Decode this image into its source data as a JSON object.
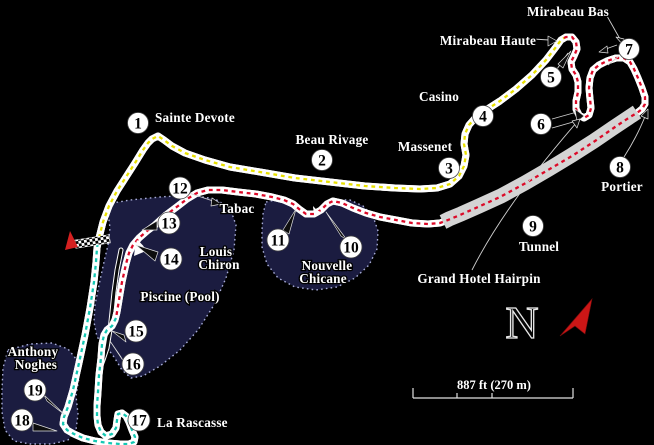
{
  "map": {
    "type": "circuit-map",
    "corners": [
      {
        "num": "1",
        "name": "Sainte Devote"
      },
      {
        "num": "2",
        "name": "Beau Rivage"
      },
      {
        "num": "3",
        "name": "Massenet"
      },
      {
        "num": "4",
        "name": "Casino"
      },
      {
        "num": "5",
        "name": "Mirabeau Haute"
      },
      {
        "num": "6",
        "name": "Grand Hotel Hairpin"
      },
      {
        "num": "7",
        "name": "Mirabeau Bas"
      },
      {
        "num": "8",
        "name": "Portier"
      },
      {
        "num": "9",
        "name": "Tunnel"
      },
      {
        "num": "10/11",
        "name": "Nouvelle Chicane"
      },
      {
        "num": "12",
        "name": "Tabac"
      },
      {
        "num": "13/14",
        "name": "Louis Chiron"
      },
      {
        "num": "15/16",
        "name": "Piscine (Pool)"
      },
      {
        "num": "17",
        "name": "La Rascasse"
      },
      {
        "num": "18/19",
        "name": "Anthony Noghes"
      }
    ]
  },
  "labels": {
    "sainte_devote": "Sainte Devote",
    "beau_rivage": "Beau Rivage",
    "massenet": "Massenet",
    "casino": "Casino",
    "mirabeau_haute": "Mirabeau Haute",
    "mirabeau_bas": "Mirabeau Bas",
    "portier": "Portier",
    "tunnel": "Tunnel",
    "grand_hotel_hairpin": "Grand Hotel Hairpin",
    "nouvelle_line1": "Nouvelle",
    "nouvelle_line2": "Chicane",
    "tabac": "Tabac",
    "louis_line1": "Louis",
    "louis_line2": "Chiron",
    "piscine": "Piscine (Pool)",
    "la_rascasse": "La Rascasse",
    "anthony_line1": "Anthony",
    "anthony_line2": "Noghes"
  },
  "numbers": {
    "t1": "1",
    "t2": "2",
    "t3": "3",
    "t4": "4",
    "t5": "5",
    "t6": "6",
    "t7": "7",
    "t8": "8",
    "t9": "9",
    "t10": "10",
    "t11": "11",
    "t12": "12",
    "t13": "13",
    "t14": "14",
    "t15": "15",
    "t16": "16",
    "t17": "17",
    "t18": "18",
    "t19": "19"
  },
  "compass": {
    "letter": "N"
  },
  "scale_bar": {
    "label": "887 ft (270 m)"
  },
  "colors": {
    "background": "#000000",
    "sector1_dash": "#e8e000",
    "sector2_dash": "#dc0a28",
    "sector3_dash": "#14c8b4",
    "tunnel_band": "#d4d4d4",
    "water_fill": "#1b1c40",
    "water_border": "#a9aed8",
    "road_edge": "#ffffff",
    "north_arrow": "#cc1616",
    "start_arrow": "#d42020"
  }
}
